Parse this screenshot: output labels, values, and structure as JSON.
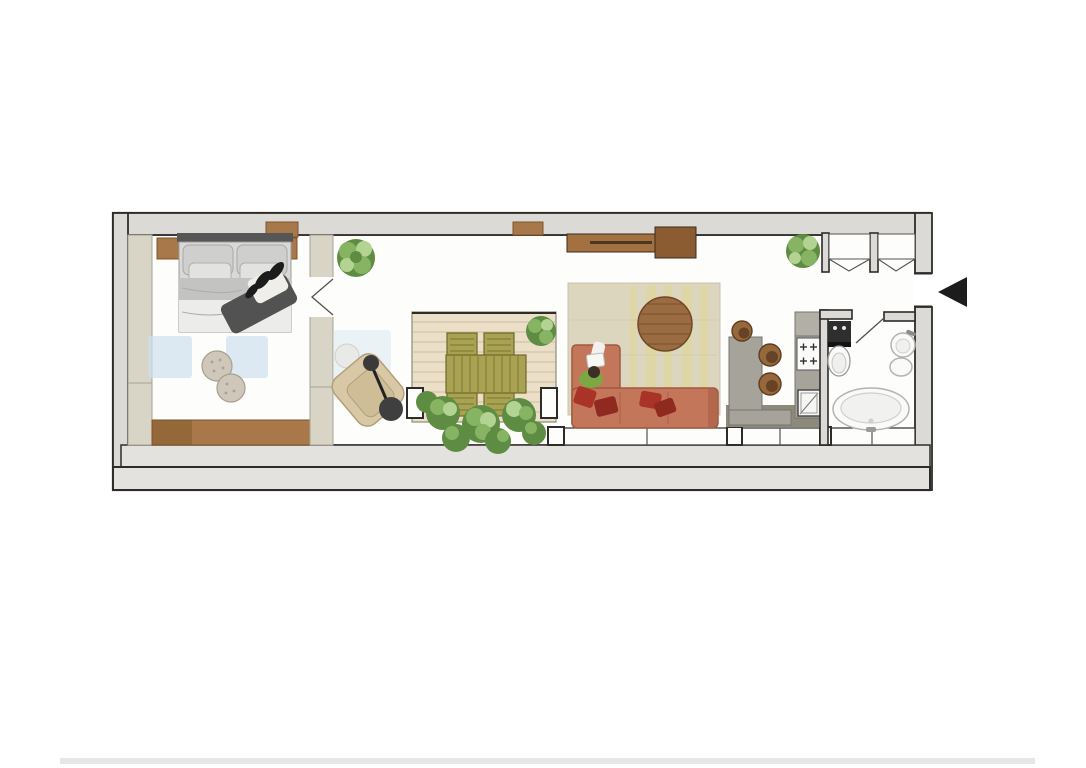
{
  "image": {
    "type": "architectural floor plan",
    "description": "Top-down rendered floor plan of a long narrow studio apartment with bedroom, hallway, recessed terrace, living room, kitchen and bathroom; entrance marked with a black arrow on the right side"
  },
  "palette": {
    "page_bg": "#ffffff",
    "wall_fill": "#dbdad6",
    "wall_line": "#2e2c2a",
    "floor_white": "#fdfdfb",
    "band_gray": "#e3e2de",
    "beige_unit": "#d9d5c6",
    "beige_line": "#a8a494",
    "wood": "#a9784a",
    "wood_dark": "#7d5429",
    "sideboard": "#a3713f",
    "sideboard_dark": "#8b5c31",
    "deck": "#ebdfc8",
    "deck_line": "#ccbda0",
    "olive": "#a8a252",
    "olive_dark": "#6e6a28",
    "green": "#86b463",
    "green_dark": "#5f8c43",
    "green_light": "#b2d392",
    "sofa": "#c4765b",
    "sofa_line": "#a2583f",
    "pillow_red": "#a93327",
    "pillow_red2": "#8f2a20",
    "rug_living": "#dcd6bf",
    "rug_accent": "#e3d687",
    "table_round": "#9b6b41",
    "kitchen_gray": "#a6a39a",
    "kitchen_dark": "#77766d",
    "kitchen_floor": "#8d8a7c",
    "stool": "#96683c",
    "stool_dark": "#5e3d22",
    "bed_gray": "#d9d9d7",
    "bed_dark": "#c3c3c1",
    "headboard": "#565656",
    "person_dark": "#525252",
    "black": "#1c1c1c",
    "blue_rug": "#cfe0ee",
    "fixture_white": "#fafaf8",
    "fixture_line": "#b3b3b1",
    "chair_beige": "#d8c8a6",
    "chair_beige_dark": "#b3a07a",
    "shirt_green": "#7da645"
  },
  "plan": {
    "orientation": "long horizontal apartment, drawn in plan view",
    "entrance": {
      "side": "right",
      "marker": "black triangle arrow pointing left into the entry opening"
    },
    "rooms": [
      {
        "name": "bedroom",
        "items": [
          "double bed with four pillows and person lying on it",
          "left nightstand",
          "right nightstand",
          "two round poufs",
          "built-in wardrobe along left wall",
          "light blue rug patches",
          "wooden floor strip along bottom wall"
        ]
      },
      {
        "name": "hallway",
        "items": [
          "wardrobe partition with open door to bedroom",
          "potted plant",
          "beige armchair",
          "black arc floor lamp"
        ]
      },
      {
        "name": "terrace",
        "items": [
          "wooden deck",
          "olive-green dining table",
          "four olive-green chairs",
          "corner potted plant",
          "row of planter shrubs along balustrade"
        ]
      },
      {
        "name": "living-room",
        "items": [
          "wall-mounted wooden sideboard",
          "beige area rug with yellow weave",
          "round wooden coffee table",
          "L-shaped terracotta sofa",
          "red scatter pillows",
          "person reading on sofa"
        ]
      },
      {
        "name": "kitchen",
        "items": [
          "grey island counter",
          "three round bar stools",
          "wall counter with four-burner gas hob",
          "oven / appliance below",
          "dark tiled floor strip"
        ]
      },
      {
        "name": "bathroom",
        "items": [
          "toilet with dark cistern unit",
          "round washbasin with tap",
          "bidet",
          "large oval bathtub",
          "door swing into room"
        ]
      },
      {
        "name": "entry",
        "items": [
          "two recessed closets with folding-door marks",
          "potted plant",
          "entrance opening in right wall"
        ]
      }
    ],
    "window_band": "glazed band with mullion ticks along bottom wall of living room, kitchen and bathroom",
    "counts": {
      "dining_chairs": 4,
      "bar_stools": 3,
      "poufs": 2,
      "plants": 8
    }
  }
}
